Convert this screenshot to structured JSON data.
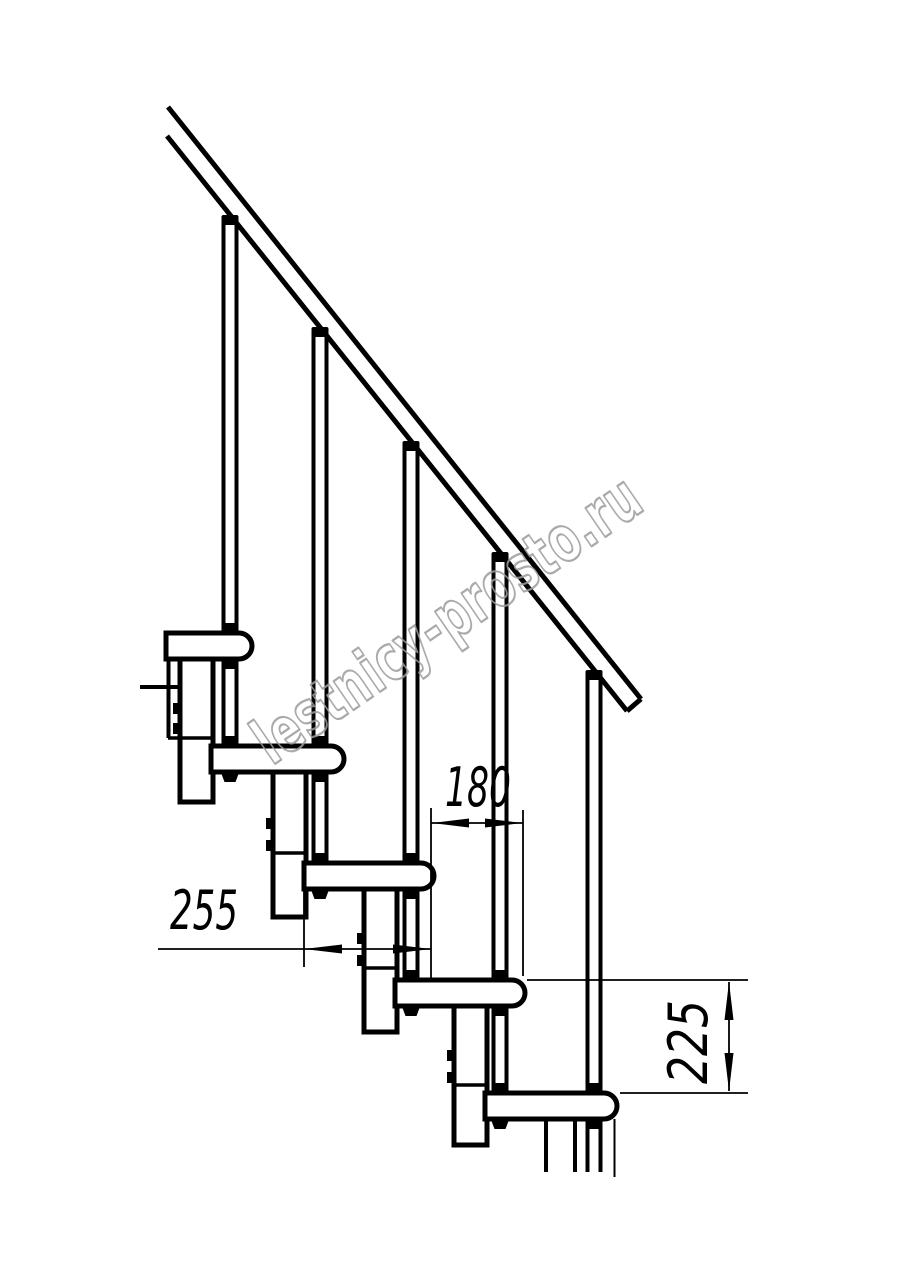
{
  "drawing": {
    "title": "Modular staircase side-view technical drawing",
    "watermark": "lestnicy-prosto.ru",
    "dimensions": {
      "tread_depth": "255",
      "tread_offset": "180",
      "step_rise": "225"
    },
    "colors": {
      "line": "#000000",
      "background": "#ffffff",
      "watermark_outline": "#9c9c9c",
      "dimension_text": "#000000"
    },
    "parts": {
      "handrail": "handrail",
      "baluster": "baluster rod",
      "tread": "stair tread",
      "column": "support column"
    },
    "counts": {
      "treads_visible": 5,
      "balusters_visible": 5
    }
  }
}
